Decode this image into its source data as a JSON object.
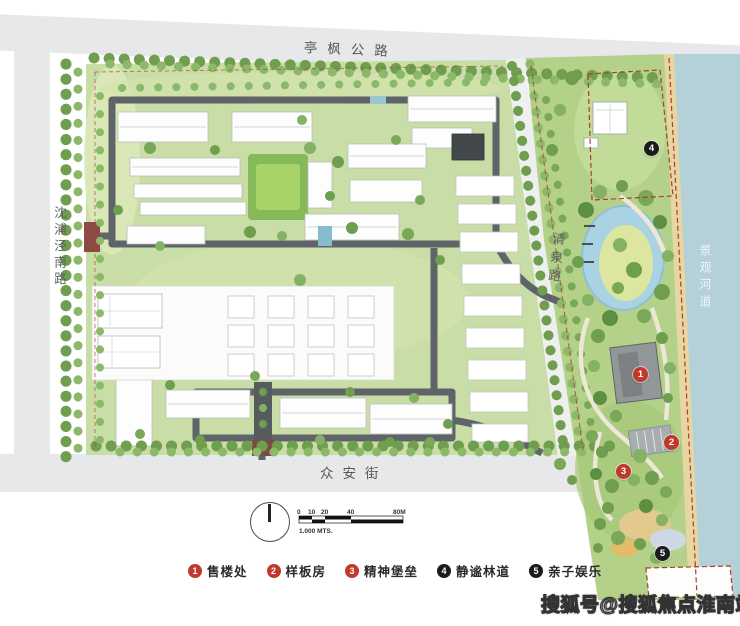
{
  "roads": {
    "top": "亭枫公路",
    "left": "沈浦泾南路",
    "bottom": "众安街",
    "middle": "清泉路",
    "river": "景观河道"
  },
  "legend": {
    "items": [
      {
        "num": "1",
        "label": "售楼处",
        "color": "#c0392b"
      },
      {
        "num": "2",
        "label": "样板房",
        "color": "#c0392b"
      },
      {
        "num": "3",
        "label": "精神堡垒",
        "color": "#c0392b"
      },
      {
        "num": "4",
        "label": "静谧林道",
        "color": "#1b1b1b"
      },
      {
        "num": "5",
        "label": "亲子娱乐",
        "color": "#1b1b1b"
      }
    ]
  },
  "scale_bar": {
    "ticks": [
      "0",
      "10",
      "20",
      "40",
      "80M"
    ],
    "note": "1.000 MTS."
  },
  "watermark": "搜狐号@搜狐焦点淮南站",
  "colors": {
    "road_gray": "#e7e8ea",
    "compound_green": "#c9dda6",
    "park_green": "#b3d189",
    "river_blue": "#b4d0d9",
    "boundary_red": "#b03a30",
    "marker_red": "#c0392b",
    "marker_black": "#1b1b1b"
  }
}
